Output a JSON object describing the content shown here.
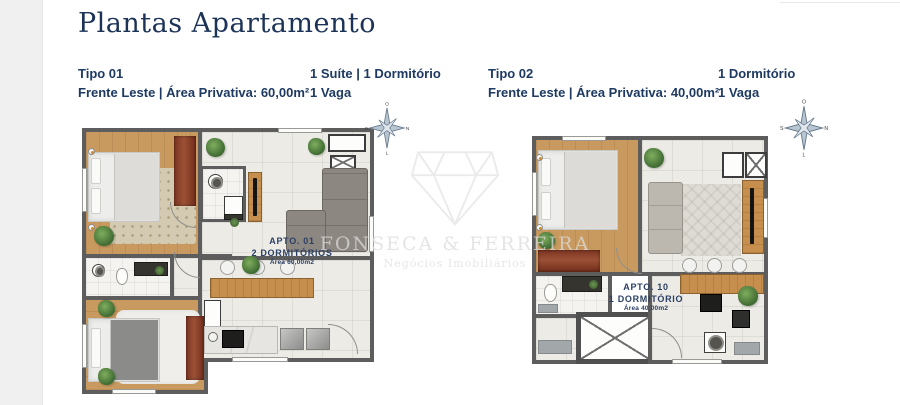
{
  "page": {
    "title": "Plantas Apartamento"
  },
  "watermark": {
    "name_line": "FONSECA & FERREIRA",
    "tagline": "Negócios Imobiliários"
  },
  "compass": {
    "top": "O",
    "right": "N",
    "bottom": "L",
    "left": "S"
  },
  "units": [
    {
      "type_label": "Tipo 01",
      "front_area": "Frente Leste | Área Privativa: 60,00m²",
      "feature_line1": "1 Suíte | 1 Dormitório",
      "feature_line2": "1 Vaga",
      "plan": {
        "apto": "Apto. 01",
        "rooms": "2 Dormitórios",
        "area": "Área 60,00m2"
      }
    },
    {
      "type_label": "Tipo 02",
      "front_area": "Frente Leste | Área Privativa: 40,00m²",
      "feature_line1": "1 Dormitório",
      "feature_line2": "1 Vaga",
      "plan": {
        "apto": "Apto. 10",
        "rooms": "1 Dormitório",
        "area": "Área 40,00m2"
      }
    }
  ]
}
